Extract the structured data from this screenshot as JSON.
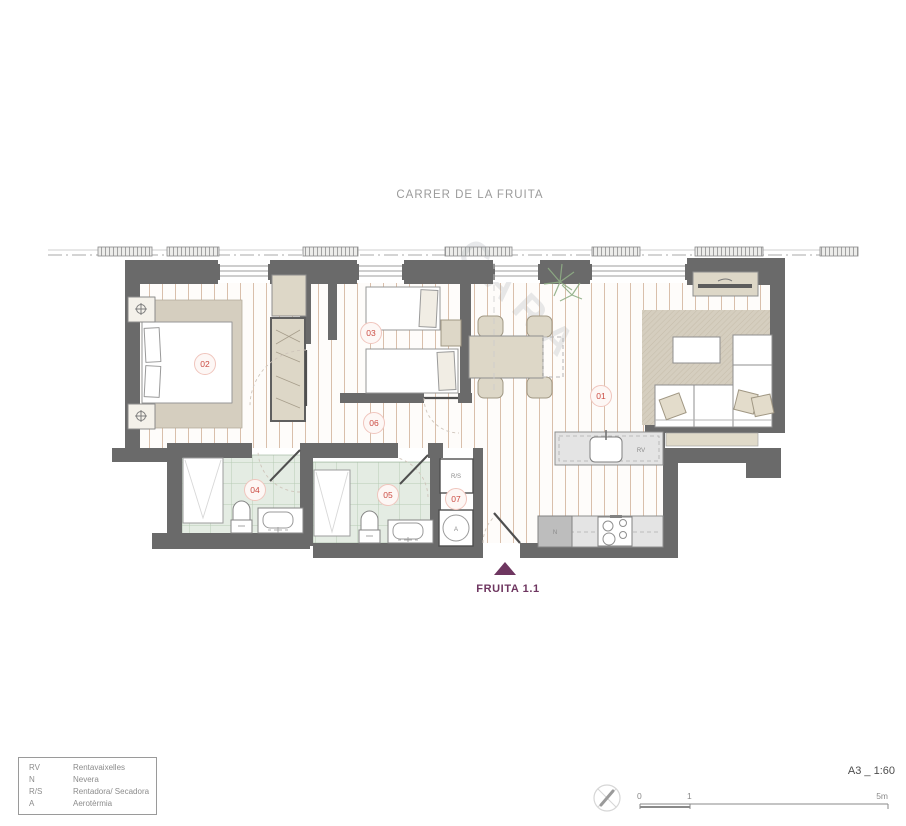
{
  "street_label": "CARRER DE LA FRUITA",
  "unit": {
    "name": "FRUITA 1.1"
  },
  "watermark": "CARA",
  "rooms": {
    "r01": "01",
    "r02": "02",
    "r03": "03",
    "r04": "04",
    "r05": "05",
    "r06": "06",
    "r07": "07"
  },
  "appliances": {
    "rv": "RV",
    "n": "N",
    "rs": "R/S",
    "a": "A"
  },
  "legend": {
    "items": [
      {
        "code": "RV",
        "label": "Rentavaixelles"
      },
      {
        "code": "N",
        "label": "Nevera"
      },
      {
        "code": "R/S",
        "label": "Rentadora/ Secadora"
      },
      {
        "code": "A",
        "label": "Aerotèrmia"
      }
    ]
  },
  "titleblock": {
    "format_scale": "A3 _ 1:60",
    "scale_ticks": {
      "start": "0",
      "mid": "1",
      "end": "5m"
    }
  },
  "colors": {
    "wall": "#6a6a6a",
    "floor_stripe": "#d9bfab",
    "bath_tile_line": "#b7cbb6",
    "bath_tile_bg": "#e4ece3",
    "furniture_beige": "#ddd7c7",
    "rug_beige": "#d5cebf",
    "label_red": "#cb4b42",
    "brand_purple": "#6e3660"
  }
}
